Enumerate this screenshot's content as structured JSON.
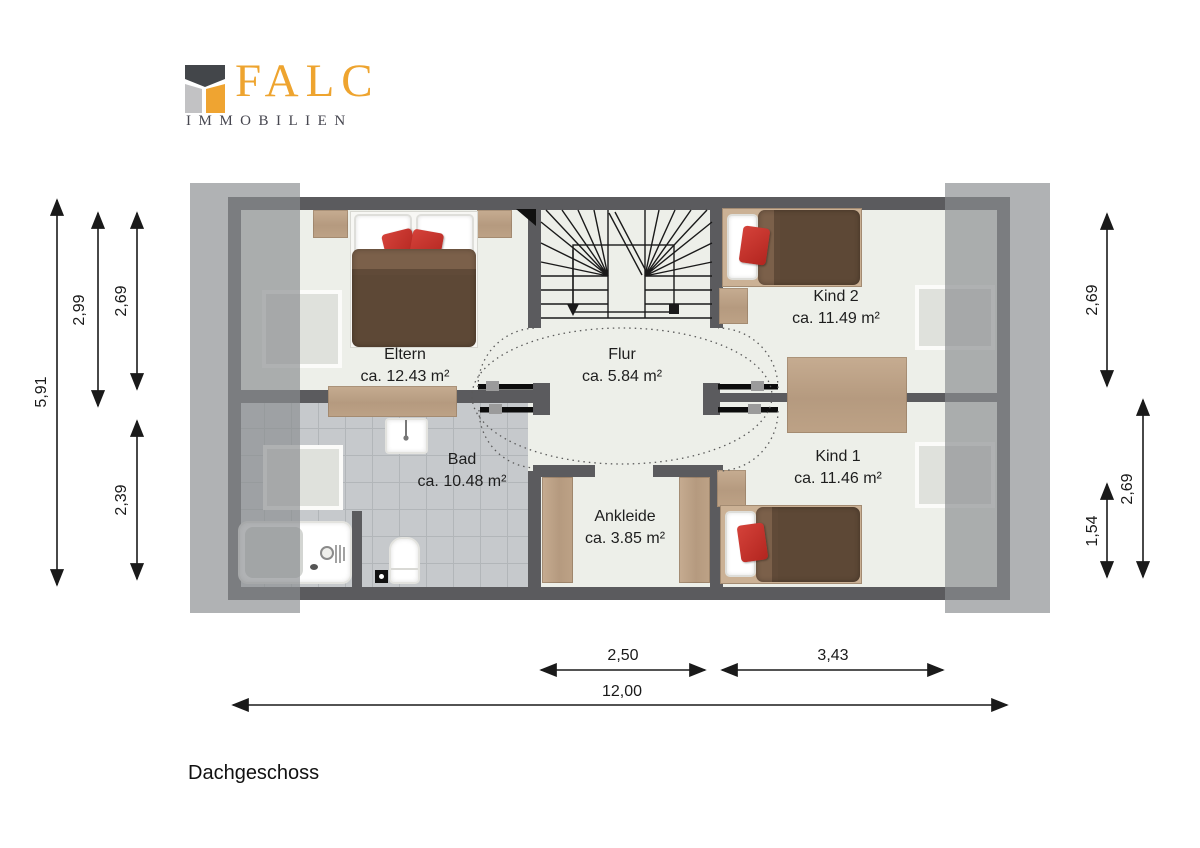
{
  "brand": {
    "name": "FALC",
    "subtitle": "IMMOBILIEN",
    "orange": "#EEA42F",
    "dark_gray": "#474750"
  },
  "floor_title": "Dachgeschoss",
  "rooms": {
    "eltern": {
      "name": "Eltern",
      "area": "ca. 12.43 m²"
    },
    "flur": {
      "name": "Flur",
      "area": "ca. 5.84 m²"
    },
    "kind2": {
      "name": "Kind 2",
      "area": "ca. 11.49 m²"
    },
    "kind1": {
      "name": "Kind 1",
      "area": "ca. 11.46 m²"
    },
    "bad": {
      "name": "Bad",
      "area": "ca. 10.48 m²"
    },
    "ankleide": {
      "name": "Ankleide",
      "area": "ca. 3.85 m²"
    }
  },
  "dimensions": {
    "left": [
      "5,91",
      "2,99",
      "2,69",
      "2,39"
    ],
    "right": [
      "2,69",
      "2,69",
      "1,54"
    ],
    "bottom": [
      "2,50",
      "3,43",
      "12,00"
    ]
  },
  "colors": {
    "wall": "#5B5B5E",
    "floor": "#EDEFE9",
    "tile": "#C6C9CC",
    "roof_overlay": "#8B8D90",
    "wood": "#B89E84",
    "accent_red": "#C5312B",
    "blanket_brown": "#5D4836"
  }
}
